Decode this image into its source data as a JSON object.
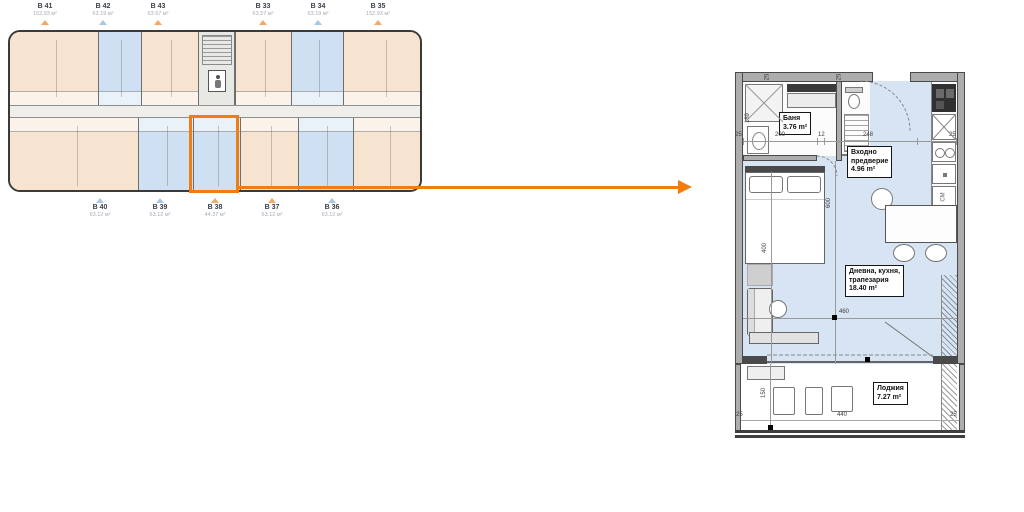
{
  "colors": {
    "accent_orange": "#F07D12",
    "floor_blue": "#D6E4F3",
    "unit_beige": "#F6E3D0",
    "unit_blue": "#CFE0F2"
  },
  "overview": {
    "top_units": [
      {
        "id": "B 41",
        "area": "152.93 м²",
        "marker": "orange"
      },
      {
        "id": "B 42",
        "area": "63.19 м²",
        "marker": "blue"
      },
      {
        "id": "B 43",
        "area": "63.57 м²",
        "marker": "orange"
      },
      {
        "id": "B 33",
        "area": "63.57 м²",
        "marker": "orange"
      },
      {
        "id": "B 34",
        "area": "63.19 м²",
        "marker": "blue"
      },
      {
        "id": "B 35",
        "area": "152.93 м²",
        "marker": "orange"
      }
    ],
    "bottom_units": [
      {
        "id": "B 40",
        "area": "63.12 м²",
        "marker": "blue"
      },
      {
        "id": "B 39",
        "area": "63.12 м²",
        "marker": "blue"
      },
      {
        "id": "B 38",
        "area": "44.37 м²",
        "marker": "orange"
      },
      {
        "id": "B 37",
        "area": "63.12 м²",
        "marker": "orange"
      },
      {
        "id": "B 36",
        "area": "63.12 м²",
        "marker": "blue"
      }
    ]
  },
  "detail": {
    "rooms": {
      "bath": {
        "name": "Баня",
        "area": "3.76 m²"
      },
      "entry": {
        "name_line1": "Входно",
        "name_line2": "предверие",
        "area": "4.96 m²"
      },
      "living": {
        "name_line1": "Дневна, кухня,",
        "name_line2": "трапезария",
        "area": "18.40 m²"
      },
      "loggia": {
        "name": "Лоджия",
        "area": "7.27 m²"
      }
    },
    "dims": {
      "t25l": "25",
      "t200": "200",
      "t12": "12",
      "t248": "248",
      "t25r": "25",
      "w25a": "25",
      "w25b": "25",
      "v189": "189",
      "v600": "600",
      "v400": "400",
      "h460": "460",
      "h440": "440",
      "v150": "150",
      "b25l": "25",
      "b25r": "25"
    },
    "appliances": {
      "washer": "СМ"
    }
  }
}
